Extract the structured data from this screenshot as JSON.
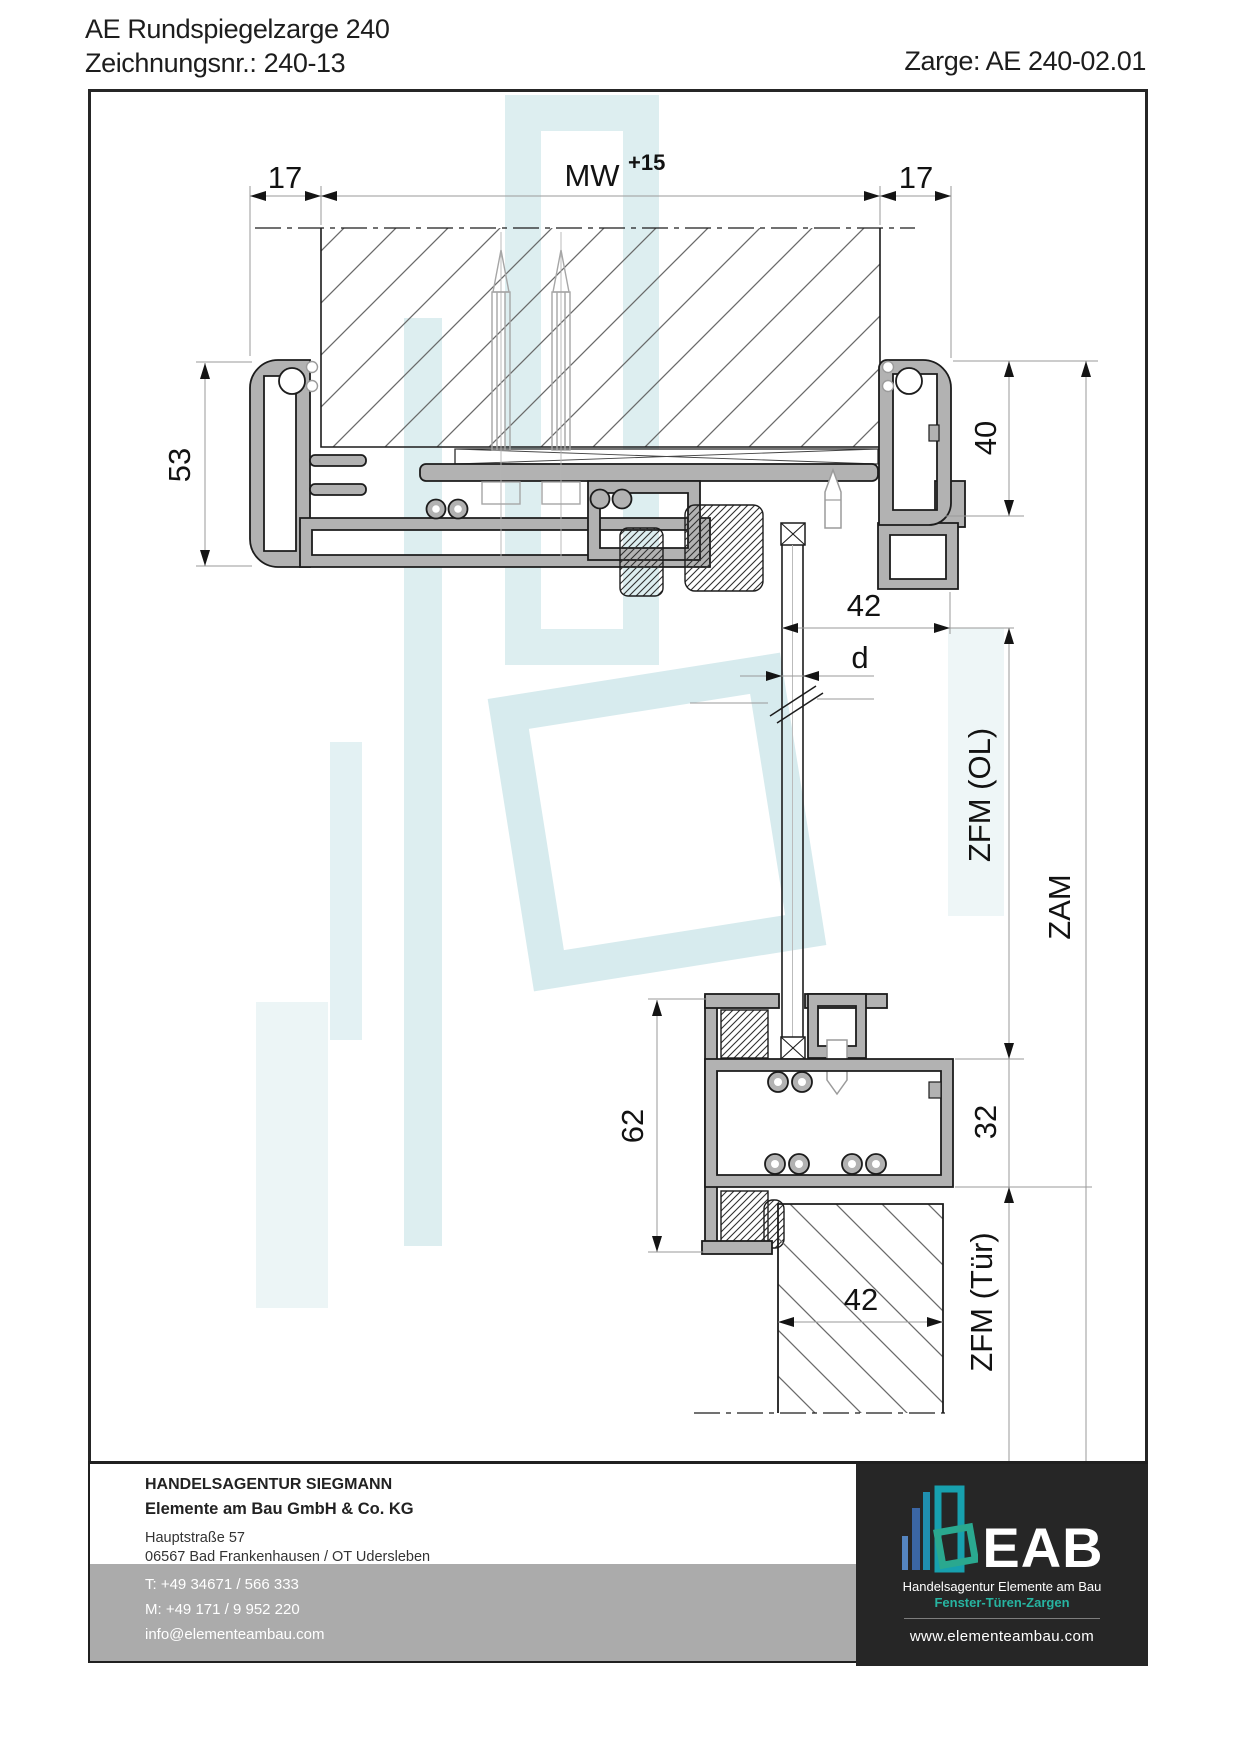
{
  "header": {
    "title": "AE Rundspiegelzarge 240",
    "drawing_no_label": "Zeichnungsnr.: 240-13",
    "zarge_label": "Zarge: AE 240-02.01"
  },
  "dimensions": {
    "top_left": "17",
    "mw": "MW",
    "mw_tolerance": "+15",
    "top_right": "17",
    "mirror_height": "53",
    "head_depth": "40",
    "rebate_offset": "42",
    "panel_thickness": "d",
    "zfm_ol": "ZFM (OL)",
    "zam": "ZAM",
    "lower_height": "62",
    "lower_depth": "32",
    "zfm_tuer": "ZFM (Tür)",
    "door_thickness": "42"
  },
  "footer": {
    "company_line1": "HANDELSAGENTUR SIEGMANN",
    "company_line2": "Elemente am Bau GmbH & Co. KG",
    "address_line1": "Hauptstraße 57",
    "address_line2": "06567 Bad Frankenhausen / OT Udersleben",
    "phone": "T: +49 34671 / 566 333",
    "mobile": "M: +49 171 / 9 952 220",
    "email": "info@elementeambau.com"
  },
  "logo": {
    "name": "EAB",
    "subtitle": "Handelsagentur Elemente am Bau",
    "tagline": "Fenster-Türen-Zargen",
    "website": "www.elementeambau.com"
  },
  "colors": {
    "profile_fill": "#b2b2b2",
    "outline": "#1c1c1c",
    "accent_teal": "#25b3a0",
    "logo_blue": "#3b66a4",
    "footer_band": "#ababab",
    "watermark": "#ddeef0",
    "black_panel": "#262626"
  }
}
